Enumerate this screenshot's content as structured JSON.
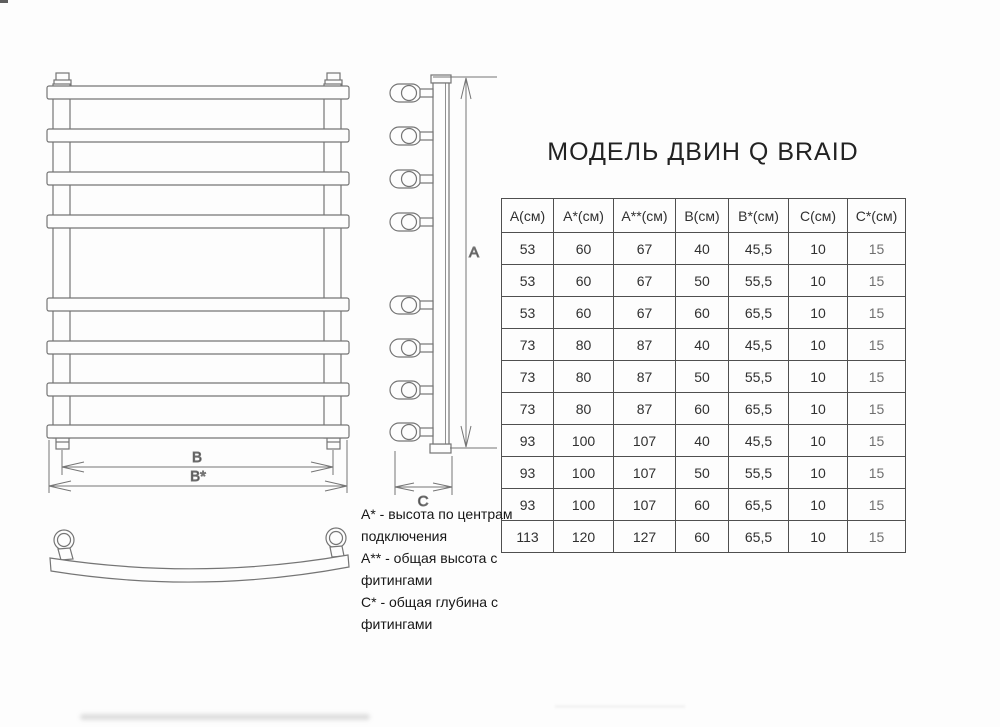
{
  "title": "МОДЕЛЬ ДВИН Q BRAID",
  "drawing": {
    "labels": {
      "a": "A",
      "b": "B",
      "b_star": "B*",
      "c": "C"
    }
  },
  "notes": [
    "А* - высота по центрам подключения",
    "А** - общая высота с фитингами",
    "С* - общая глубина с фитингами"
  ],
  "table": {
    "headers": [
      "А(см)",
      "А*(см)",
      "А**(см)",
      "В(см)",
      "В*(см)",
      "С(см)",
      "С*(см)"
    ],
    "rows": [
      [
        "53",
        "60",
        "67",
        "40",
        "45,5",
        "10",
        "15"
      ],
      [
        "53",
        "60",
        "67",
        "50",
        "55,5",
        "10",
        "15"
      ],
      [
        "53",
        "60",
        "67",
        "60",
        "65,5",
        "10",
        "15"
      ],
      [
        "73",
        "80",
        "87",
        "40",
        "45,5",
        "10",
        "15"
      ],
      [
        "73",
        "80",
        "87",
        "50",
        "55,5",
        "10",
        "15"
      ],
      [
        "73",
        "80",
        "87",
        "60",
        "65,5",
        "10",
        "15"
      ],
      [
        "93",
        "100",
        "107",
        "40",
        "45,5",
        "10",
        "15"
      ],
      [
        "93",
        "100",
        "107",
        "50",
        "55,5",
        "10",
        "15"
      ],
      [
        "93",
        "100",
        "107",
        "60",
        "65,5",
        "10",
        "15"
      ],
      [
        "113",
        "120",
        "127",
        "60",
        "65,5",
        "10",
        "15"
      ]
    ]
  },
  "colors": {
    "paper": "#fdfdfd",
    "line": "#757575",
    "table_border": "#4f4f4f",
    "text": "#2a2a2a"
  }
}
